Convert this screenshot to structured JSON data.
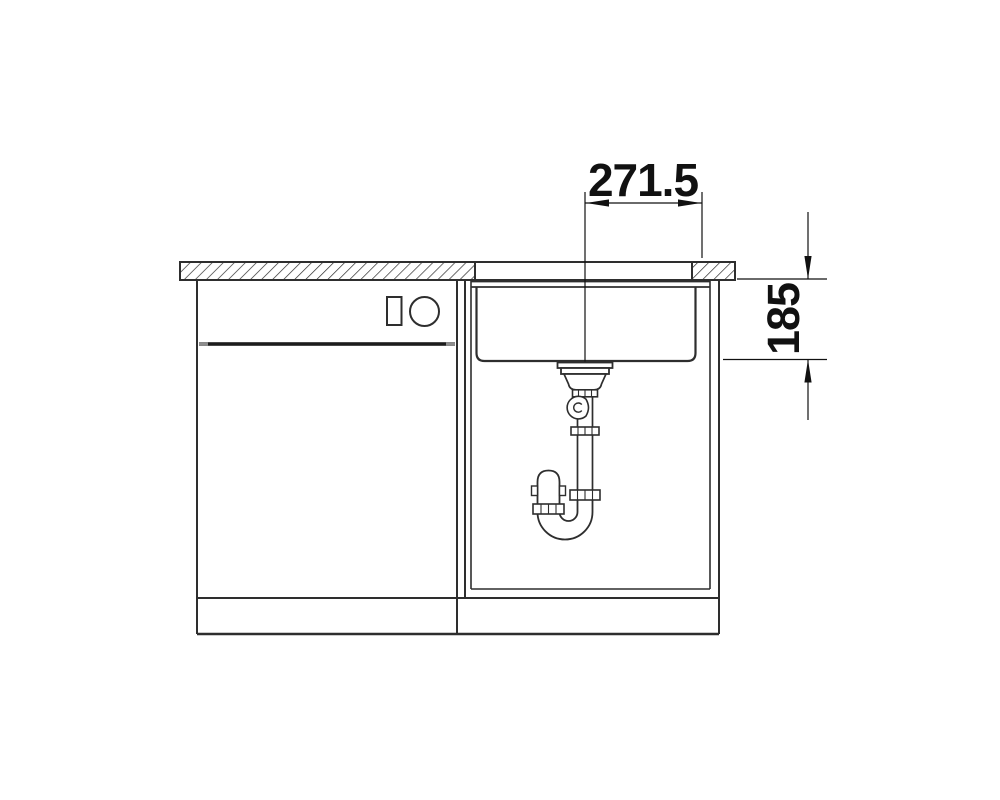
{
  "drawing": {
    "dimensions": {
      "width_offset": "271.5",
      "depth": "185"
    },
    "colors": {
      "line": "#2e2e2e",
      "dimension": "#111111",
      "door_gap": "#1c1c1c",
      "door_gap_cap": "#8d8d8d",
      "background": "#ffffff"
    },
    "icons": {
      "appliance_button": "rect-symbol",
      "appliance_knob": "circle-symbol",
      "countertop_hatch": "diagonal-section-hatch"
    }
  }
}
